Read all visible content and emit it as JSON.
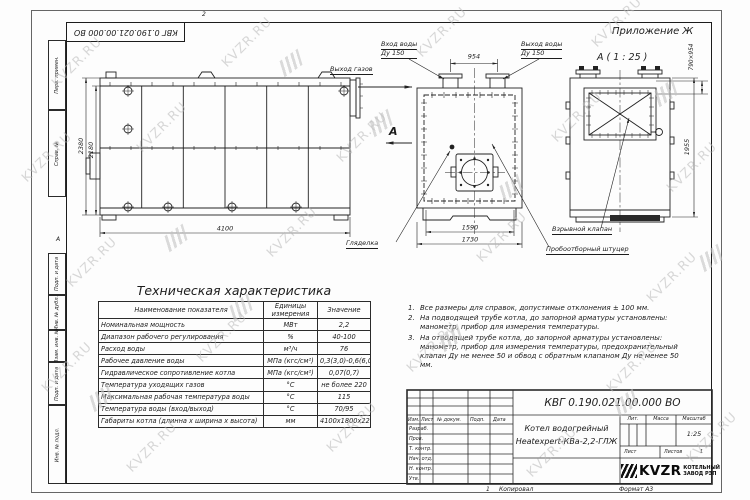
{
  "sheet": {
    "appendix_label": "Приложение Ж",
    "doc_number_rotated": "КВГ 0.190.021.00.000 ВО",
    "zone_top": "2",
    "zone_left": "А",
    "bottom": {
      "zone": "1",
      "copied": "Копировал",
      "format": "Формат А3"
    }
  },
  "frame_columns": {
    "top": [
      "Перв. примен.",
      "Справ. №"
    ],
    "bottom": [
      "Подп. и дата",
      "Инв. № дубл.",
      "Взам. инв. №",
      "Подп. и дата",
      "Инв. № подл."
    ]
  },
  "views": {
    "side": {
      "dim_height_outer": "2380",
      "dim_height_inner": "2180",
      "dim_length": "4100",
      "label_gas_out": "Выход газов"
    },
    "front": {
      "label_in_1": "Вход воды",
      "label_in_2": "Ду 150",
      "label_out_1": "Выход воды",
      "label_out_2": "Ду 150",
      "dim_top": "954",
      "dim_inner": "1590",
      "dim_outer": "1730",
      "section_mark": "А",
      "label_sight": "Гляделка",
      "label_sampler": "Пробоотборный штуцер"
    },
    "section": {
      "title": "А ( 1 : 25 )",
      "dim_height": "1955",
      "dim_hatch": "790×954",
      "label_valve": "Взрывной клапан"
    }
  },
  "table": {
    "title": "Техническая характеристика",
    "headers": [
      "Наименование показателя",
      "Единицы измерения",
      "Значение"
    ],
    "rows": [
      [
        "Номинальная мощность",
        "МВт",
        "2,2"
      ],
      [
        "Диапазон рабочего регулирования",
        "%",
        "40-100"
      ],
      [
        "Расход воды",
        "м³/ч",
        "76"
      ],
      [
        "Рабочее давление воды",
        "МПа (кгс/см²)",
        "0,3(3,0)-0,6(6,0)"
      ],
      [
        "Гидравлическое сопротивление котла",
        "МПа (кгс/см²)",
        "0,07(0,7)"
      ],
      [
        "Температура уходящих газов",
        "°С",
        "не более 220"
      ],
      [
        "Максимальная рабочая температура воды",
        "°С",
        "115"
      ],
      [
        "Температура воды (вход/выход)",
        "°С",
        "70/95"
      ],
      [
        "Габариты котла (длинна х ширина х высота)",
        "мм",
        "4100х1800х2280"
      ]
    ]
  },
  "notes": [
    {
      "num": "1.",
      "text": "Все размеры для справок, допустимые отклонения ± 100 мм."
    },
    {
      "num": "2.",
      "text": "На подводящей трубе котла, до запорной арматуры установлены: манометр, прибор для измерения температуры."
    },
    {
      "num": "3.",
      "text": "На отводящей трубе котла, до запорной арматуры установлены: манометр, прибор для измерения температуры, предохранительный клапан Ду не менее 50 и обвод с обратным клапаном Ду не менее 50 мм."
    }
  ],
  "title_block": {
    "doc_number": "КВГ 0.190.021.00.000 ВО",
    "product_line1": "Котел водогрейный",
    "product_line2": "Heatexpert-КВа-2,2-ГЛЖ",
    "col_headers": [
      "Изм.",
      "Лист",
      "№ докум.",
      "Подп.",
      "Дата"
    ],
    "row_labels": [
      "Разраб.",
      "Пров.",
      "Т. контр.",
      "Нач. отд.",
      "Н. контр.",
      "Утв."
    ],
    "lit_label": "Лит.",
    "mass_label": "Масса",
    "scale_label": "Масштаб",
    "scale_value": "1:25",
    "sheet_label": "Лист",
    "sheets_label": "Листов",
    "sheets_value": "1",
    "logo_text": "KVZR",
    "logo_caption1": "КОТЕЛЬНЫЙ",
    "logo_caption2": "ЗАВОД РЭП"
  },
  "watermark": {
    "text": "KVZR.RU"
  }
}
